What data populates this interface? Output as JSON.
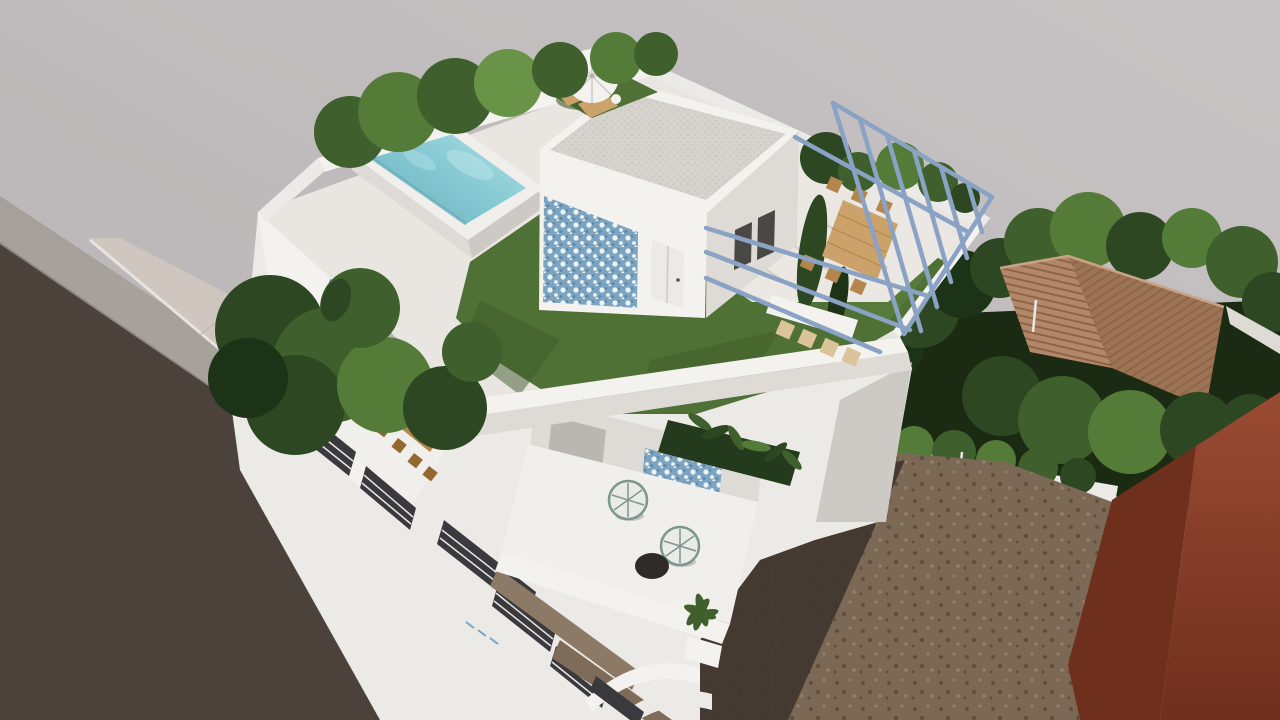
{
  "scene": {
    "type": "3d-architectural-render",
    "description": "Aerial 3D rendering of a modern white multi-storey villa: rooftop terrace with raised pool, lawn, pebbled penthouse roof, steel pergola over a dining set, umbrella lounge nook, tiled balcony facades over a street, neighbouring terracotta-roof house, hedges, dirt lot and a red-brown building corner",
    "inventory": {
      "rooftop_pool": 1,
      "parasol_umbrella": 1,
      "sun_loungers": 2,
      "pergola_rafters": 6,
      "pergola_rails": 5,
      "pergola_dining_chairs": 6,
      "bench_chairs": 4,
      "terrace_dining_chairs": 5,
      "acapulco_chairs": 2,
      "round_side_table": 1,
      "facade_balcony_openings": 5,
      "neighbour_roofs": 2,
      "street_lanes": 1
    },
    "colors": {
      "bg_top": "#c7c3c4",
      "bg_bottom": "#b7b2b3",
      "road": "#4b423c",
      "sidewalk_far": "#a7a19c",
      "sidewalk_near": "#cfc7bf",
      "curb": "#e7e3de",
      "paving_line": "#bdb5ad",
      "white_bright": "#f4f2ee",
      "white": "#eceae6",
      "white_shade": "#dedad5",
      "white_dim": "#cdc9c4",
      "deck": "#e9e6e2",
      "deck_light": "#ebe8e4",
      "terrace": "#f1efeb",
      "lawn": "#4f7135",
      "lawn_dark": "#3e5a29",
      "lawn_light": "#5e8540",
      "pool_rim": "#f1efec",
      "water": "#8accd5",
      "water_deep": "#66aebd",
      "water_light": "#b9e4e9",
      "pool_wall": "#5fa8b6",
      "pebble_bg": "#d6d2cd",
      "pebble_dot": "#c3bfb9",
      "azulejo_bg": "#7ca4c0",
      "azulejo_light": "#ecf3f6",
      "azulejo_dark": "#5c86a4",
      "pergola": "#8aa2c3",
      "wood": "#b5854e",
      "wood_dark": "#93682f",
      "wood_light": "#cba36a",
      "wood_pale": "#dcc49a",
      "tile": "#b3886a",
      "tile_rib": "#8f6548",
      "tile_shade": "#9c7354",
      "dirt": "#7b6855",
      "dirt_dark": "#5e4f40",
      "dirt_light": "#94816b",
      "shadow": "#3c332b",
      "garden_dark": "#1b2a12",
      "red_face": "#9a4b33",
      "red_face_dark": "#6f2f1d",
      "slot": "#3a393e",
      "stripe": "#e9e7e3",
      "glass": "#bab6b2",
      "planter": "#243a1c",
      "black_table": "#2f2b28",
      "chair_wire": "#7e978c",
      "chair_seat": "#e8ebe8",
      "tree_darkest": "#1d3317",
      "tree_dark": "#2c4721",
      "tree_mid": "#3f5f2c",
      "tree_light": "#547c38",
      "tree_lighter": "#699448"
    }
  }
}
